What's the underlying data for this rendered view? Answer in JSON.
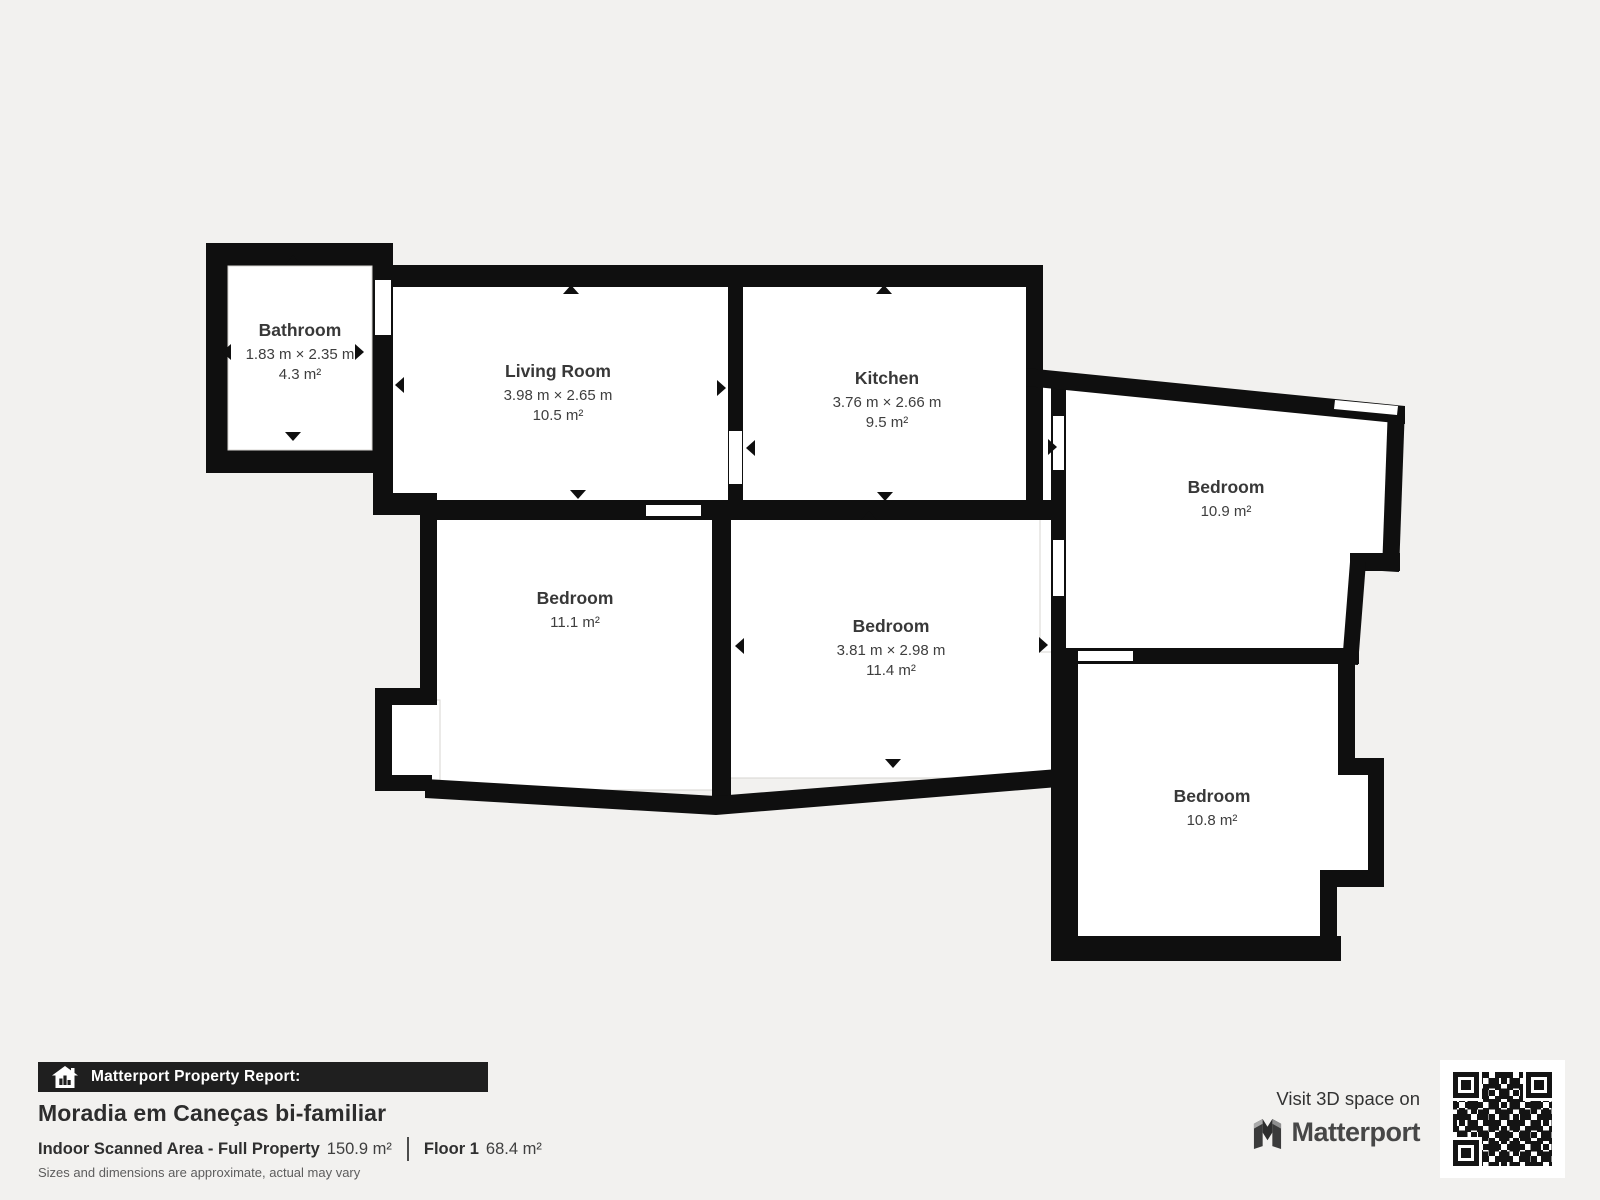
{
  "floorplan": {
    "rooms": [
      {
        "name": "Bathroom",
        "dimensions": "1.83 m × 2.35 m",
        "area": "4.3 m²"
      },
      {
        "name": "Living Room",
        "dimensions": "3.98 m × 2.65 m",
        "area": "10.5 m²"
      },
      {
        "name": "Kitchen",
        "dimensions": "3.76 m × 2.66 m",
        "area": "9.5 m²"
      },
      {
        "name": "Bedroom",
        "dimensions": "",
        "area": "10.9 m²"
      },
      {
        "name": "Bedroom",
        "dimensions": "",
        "area": "11.1 m²"
      },
      {
        "name": "Bedroom",
        "dimensions": "3.81 m × 2.98 m",
        "area": "11.4 m²"
      },
      {
        "name": "Bedroom",
        "dimensions": "",
        "area": "10.8 m²"
      }
    ]
  },
  "footer": {
    "banner": "Matterport Property Report:",
    "title": "Moradia em Caneças bi-familiar",
    "stat1_label": "Indoor Scanned Area - Full Property",
    "stat1_value": "150.9 m²",
    "stat2_label": "Floor 1",
    "stat2_value": "68.4 m²",
    "disclaimer": "Sizes and dimensions are approximate, actual may vary"
  },
  "cta": {
    "line1": "Visit 3D space on",
    "brand": "Matterport"
  },
  "icons": {
    "banner_icon": "house-chart-icon",
    "brand_icon": "matterport-logo-icon",
    "qr": "qr-code"
  },
  "colors": {
    "background": "#f2f1ef",
    "walls": "#0f0f0f",
    "banner_bg": "#1f1f1f",
    "room_text": "#3c3c3c"
  }
}
